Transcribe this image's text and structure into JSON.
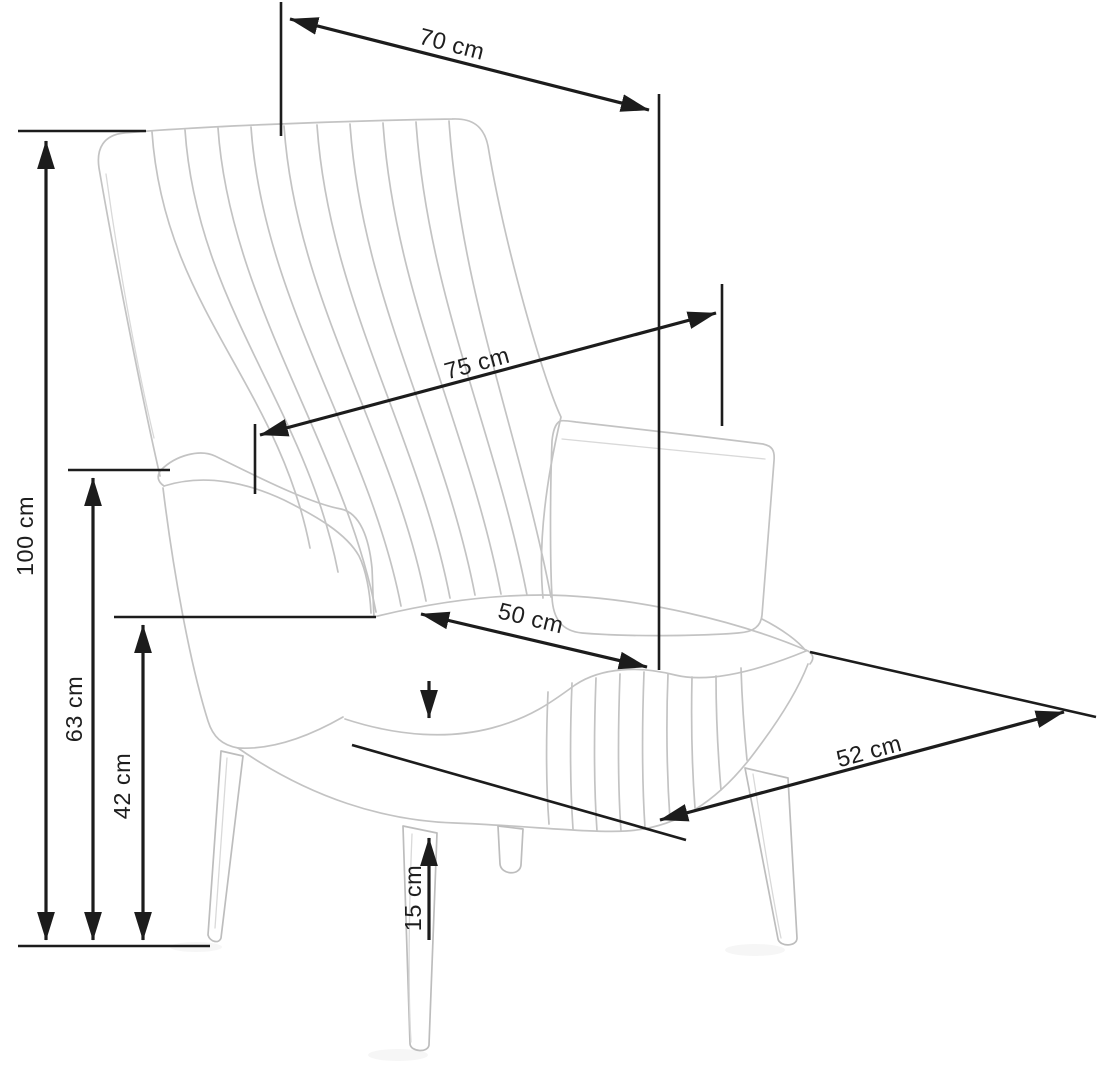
{
  "diagram": {
    "subject": "wingback-armchair-dimension-drawing",
    "colors": {
      "background": "#ffffff",
      "dimension_lines": "#1c1c1c",
      "chair_lines": "#c3c3c3",
      "labels": "#1e1e1e"
    },
    "dimensions": {
      "back_width": {
        "label": "70 cm",
        "value": 70,
        "unit": "cm"
      },
      "total_depth": {
        "label": "75 cm",
        "value": 75,
        "unit": "cm"
      },
      "total_height": {
        "label": "100 cm",
        "value": 100,
        "unit": "cm"
      },
      "arm_height": {
        "label": "63 cm",
        "value": 63,
        "unit": "cm"
      },
      "seat_height": {
        "label": "42 cm",
        "value": 42,
        "unit": "cm"
      },
      "seat_width": {
        "label": "50 cm",
        "value": 50,
        "unit": "cm"
      },
      "leg_height": {
        "label": "15 cm",
        "value": 15,
        "unit": "cm"
      },
      "seat_depth": {
        "label": "52 cm",
        "value": 52,
        "unit": "cm"
      }
    }
  }
}
